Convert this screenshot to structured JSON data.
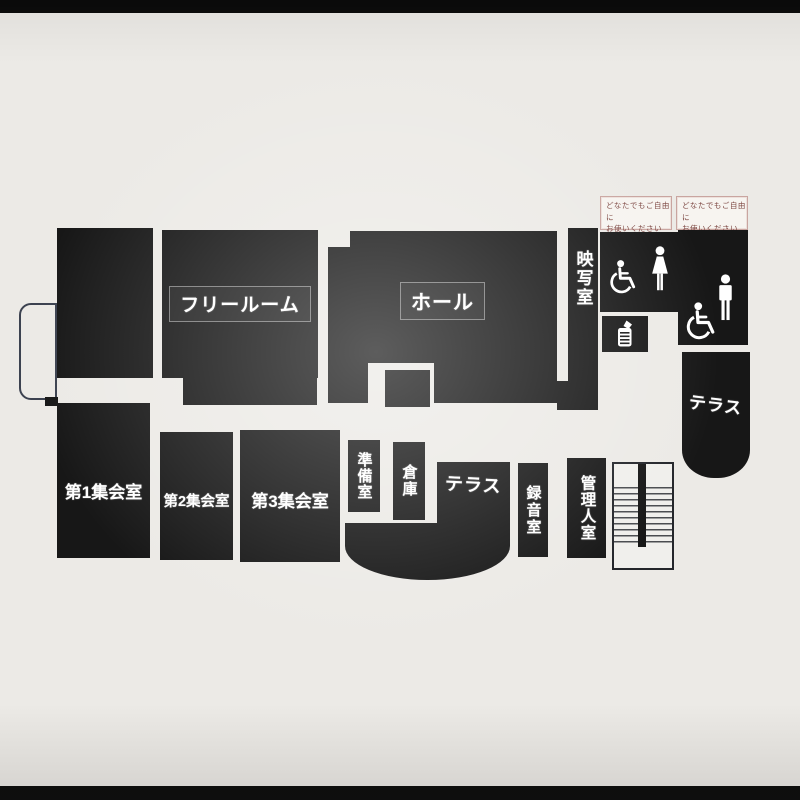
{
  "photo": {
    "frame_color": "#0b0b0b",
    "board_color": "#eceae6",
    "ink_color": "#171717"
  },
  "rooms": {
    "free_room": "フリールーム",
    "hall": "ホール",
    "projection_room": "映写室",
    "meeting_room_1": "第1集会室",
    "meeting_room_2": "第2集会室",
    "meeting_room_3": "第3集会室",
    "prep_room": "準備室",
    "storage": "倉庫",
    "terrace_south": "テラス",
    "recording_room": "録音室",
    "caretaker_room": "管理人室",
    "terrace_east": "テラス"
  },
  "signs": {
    "left": {
      "line1": "どなたでもご自由に",
      "line2": "お使いください"
    },
    "right": {
      "line1": "どなたでもご自由に",
      "line2": "お使いください"
    }
  },
  "icons": {
    "accessible_left": "wheelchair-icon",
    "woman": "woman-icon",
    "man": "man-icon",
    "accessible_right": "wheelchair-icon",
    "facility": "diaper-changing-icon"
  }
}
